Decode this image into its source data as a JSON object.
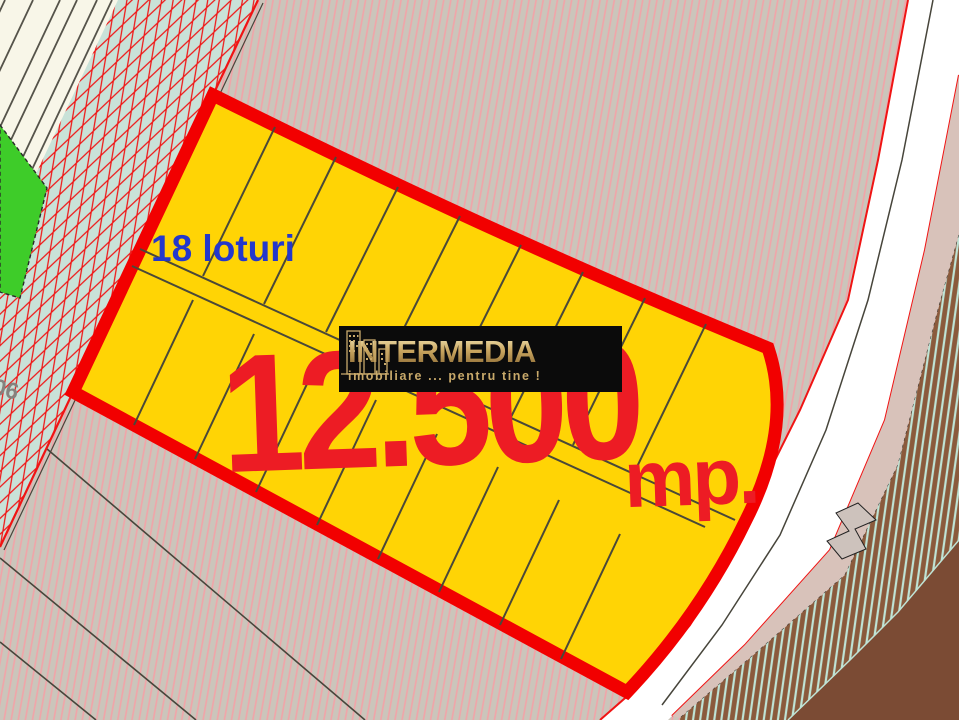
{
  "map": {
    "parcel": {
      "lots_label": "18 loturi",
      "area_value": "12.500",
      "area_unit": "mp."
    },
    "cadastral_label": "06",
    "watermark": {
      "brand": "INTERMEDIA",
      "tagline": "imobiliare ... pentru tine !"
    },
    "colors": {
      "background": "#CBC5BB",
      "hatch_pink": "#F2A3A8",
      "cream": "#F8F6E8",
      "boundary_dark": "#47453B",
      "road_teal": "#C9E2D8",
      "hatch_red": "#F01414",
      "green_parcel": "#3ECC29",
      "parcel_fill": "#FFD405",
      "parcel_border": "#F20000",
      "lot_line": "#4A4839",
      "road_white": "#FFFFFF",
      "shoulder_pink": "#D8C2BA",
      "brown_field": "#8A5A3C",
      "stripe_teal": "#BFE4D6",
      "brown_solid": "#7B4B34",
      "area_text": "#ED1C24",
      "lots_text": "#2438CC",
      "logo_bg": "#0B0B0B",
      "logo_gold": "#C8A96A"
    }
  }
}
